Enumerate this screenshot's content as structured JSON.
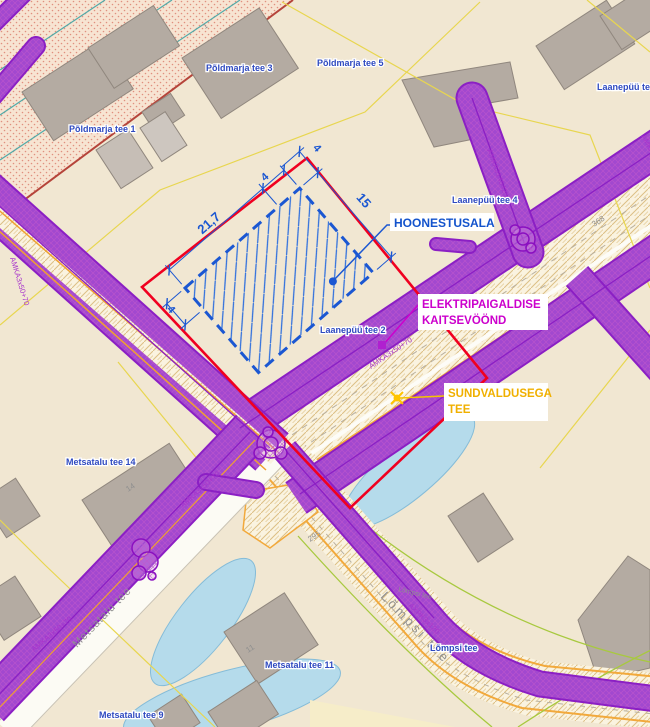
{
  "map": {
    "callouts": {
      "hoonestusala": "HOONESTUSALA",
      "elektri_line1": "ELEKTRIPAIGALDISE",
      "elektri_line2": "KAITSEVÖÖND",
      "sundvaldus_line1": "SUNDVALDUSEGA",
      "sundvaldus_line2": "TEE"
    },
    "dimensions": {
      "width": "21,7",
      "height": "15",
      "setback_top": "4",
      "setback_right": "4",
      "setback_left": "4"
    },
    "streets": {
      "poldmarja5": "Põldmarja tee 5",
      "poldmarja3": "Põldmarja tee 3",
      "poldmarja1": "Põldmarja tee 1",
      "laanepuu": "Laanepüü tee",
      "laanepuu4": "Laanepüü tee 4",
      "laanepuu2": "Laanepüü tee 2",
      "metsatalu14": "Metsatalu tee 14",
      "metsatalu11": "Metsatalu tee 11",
      "metsatalu9": "Metsatalu tee 9",
      "lompsi_blue": "Lõmpsi tee"
    },
    "roads": {
      "metsatalu": "Metsatalu tee",
      "lompsi": "Lõmpsi tee",
      "lompsi_small": "Lõmpsi tee"
    },
    "lots": {
      "n368": "368",
      "n295": "295",
      "n14": "14",
      "n11": "11",
      "n1": "1"
    },
    "cables": {
      "amka_id": "AMKA3146425",
      "amka_type": "AMKA3x50+70",
      "axpk_type": "AXPK3x120"
    },
    "colors": {
      "background": "#f1e7d2",
      "boundary_red": "#f00020",
      "building_area_blue": "#1b57d2",
      "protection_purple": "#8b1fc4",
      "label_magenta": "#cc00cc",
      "label_yellow": "#f0b000",
      "water": "#b5dbeb",
      "building_gray": "#b4aba2",
      "cadastral_yellow": "#e8d64f",
      "road_orange": "#f2a93b"
    }
  }
}
